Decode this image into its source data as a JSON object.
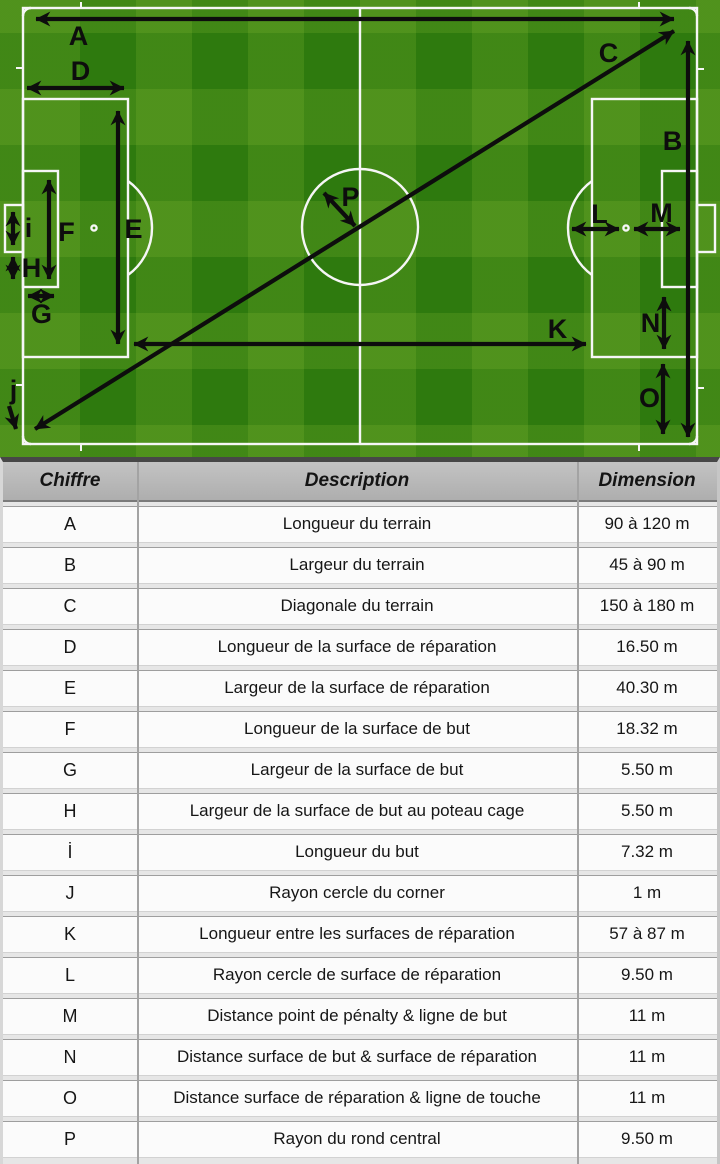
{
  "field": {
    "labels": [
      "A",
      "B",
      "C",
      "D",
      "E",
      "F",
      "G",
      "H",
      "i",
      "j",
      "K",
      "L",
      "M",
      "N",
      "O",
      "P"
    ]
  },
  "table": {
    "headers": [
      "Chiffre",
      "Description",
      "Dimension"
    ],
    "rows": [
      [
        "A",
        "Longueur du terrain",
        "90 à 120 m"
      ],
      [
        "B",
        "Largeur du terrain",
        "45 à 90 m"
      ],
      [
        "C",
        "Diagonale du terrain",
        "150 à 180 m"
      ],
      [
        "D",
        "Longueur de la surface de réparation",
        "16.50 m"
      ],
      [
        "E",
        "Largeur de la surface de réparation",
        "40.30 m"
      ],
      [
        "F",
        "Longueur de la surface de but",
        "18.32 m"
      ],
      [
        "G",
        "Largeur de la surface de but",
        "5.50 m"
      ],
      [
        "H",
        "Largeur de la surface de but au poteau cage",
        "5.50 m"
      ],
      [
        "İ",
        "Longueur du but",
        "7.32 m"
      ],
      [
        "J",
        "Rayon cercle du corner",
        "1 m"
      ],
      [
        "K",
        "Longueur entre les surfaces de réparation",
        "57 à 87 m"
      ],
      [
        "L",
        "Rayon cercle de surface de réparation",
        "9.50 m"
      ],
      [
        "M",
        "Distance point de pénalty & ligne de but",
        "11 m"
      ],
      [
        "N",
        "Distance surface de but & surface de réparation",
        "11 m"
      ],
      [
        "O",
        "Distance surface de réparation & ligne de touche",
        "11 m"
      ],
      [
        "P",
        "Rayon du rond central",
        "9.50 m"
      ]
    ]
  },
  "colors": {
    "pitch_green_dark": "#2e7a0e",
    "pitch_green_light": "#4d9422",
    "line_white": "#f6f6f6",
    "arrow_black": "#0d0d0d",
    "header_grey": "#b5b5b5",
    "row_white": "#fbfbfb"
  }
}
